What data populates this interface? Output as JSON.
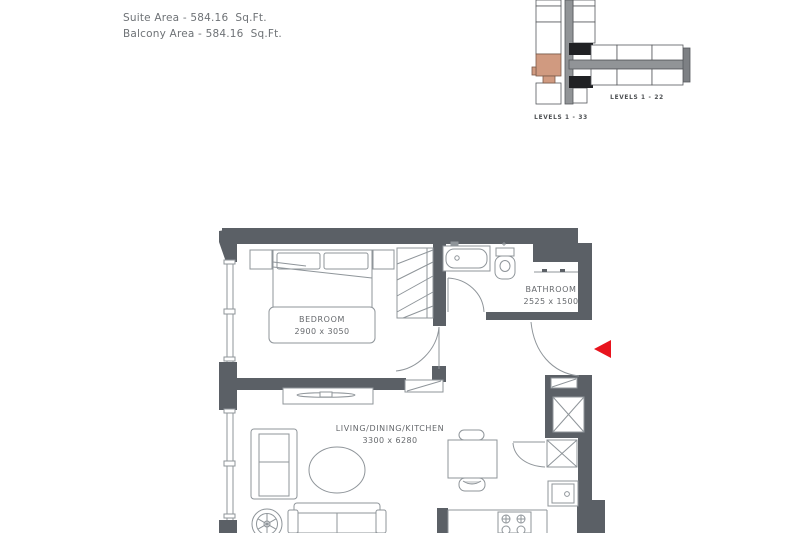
{
  "area_info": {
    "suite": "Suite Area - 584.16  Sq.Ft.",
    "balcony": "Balcony Area - 584.16  Sq.Ft."
  },
  "key_plan": {
    "tower_label": "LEVELS 1 - 33",
    "wing_label": "LEVELS 1 - 22",
    "highlight_color": "#d09a80",
    "corridor_color": "#919497",
    "core_color": "#202124"
  },
  "floor_plan": {
    "wall_color": "#5b6066",
    "line_color": "#8f959a",
    "entry_marker_color": "#e8131d",
    "rooms": [
      {
        "name": "BEDROOM",
        "dimensions": "2900 x 3050"
      },
      {
        "name": "BATHROOM",
        "dimensions": "2525 x 1500"
      },
      {
        "name": "LIVING/DINING/KITCHEN",
        "dimensions": "3300 x 6280"
      }
    ]
  }
}
